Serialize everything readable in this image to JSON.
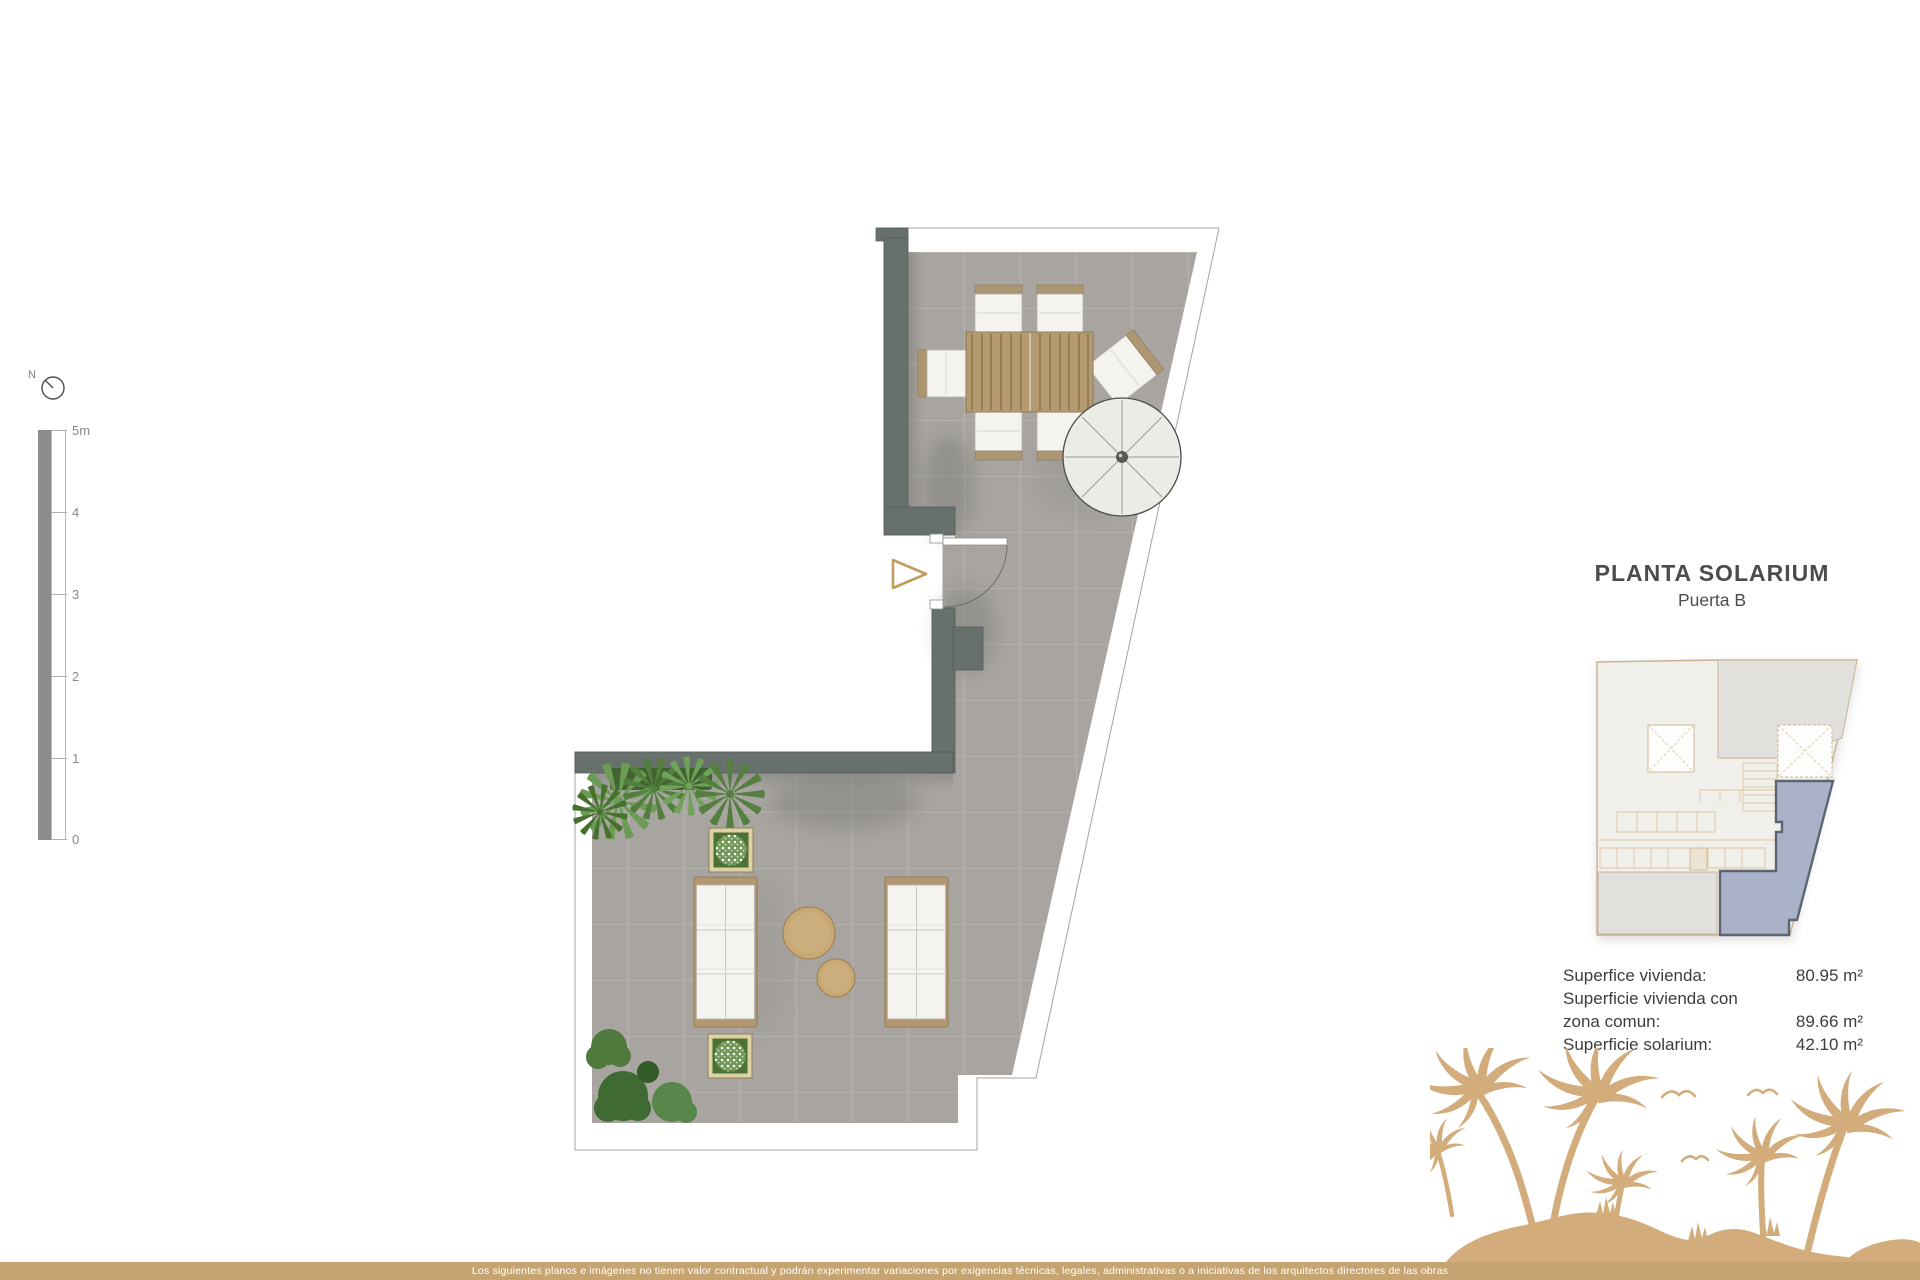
{
  "colors": {
    "accent-tan": "#c9a36c",
    "palm-tan": "#d3ac7b",
    "bar-tan": "#c6a471",
    "wall-gray": "#68706d",
    "floor-gray": "#a8a5a0",
    "unit-highlight": "#a9b2c6",
    "unit-border": "#5d6574",
    "text-dark": "#4c4c4c",
    "plant-green": "#5e8f4a"
  },
  "compass": {
    "label": "N"
  },
  "scale_bar": {
    "labels": [
      "5m",
      "4",
      "3",
      "2",
      "1",
      "0"
    ]
  },
  "title_block": {
    "title": "PLANTA SOLARIUM",
    "subtitle": "Puerta B"
  },
  "areas": {
    "rows": [
      {
        "label": "Superfice vivienda:",
        "value": "80.95 m²"
      },
      {
        "label": "Superficie vivienda con",
        "value": ""
      },
      {
        "label": "zona comun:",
        "value": "89.66 m²"
      },
      {
        "label": "Superficie solarium:",
        "value": "42.10 m²"
      }
    ]
  },
  "footer": {
    "disclaimer": "Los siguientes planos e imágenes no tienen valor contractual y podrán experimentar variaciones por exigencias técnicas, legales, administrativas o a iniciativas de los arquitectos directores de las obras"
  }
}
